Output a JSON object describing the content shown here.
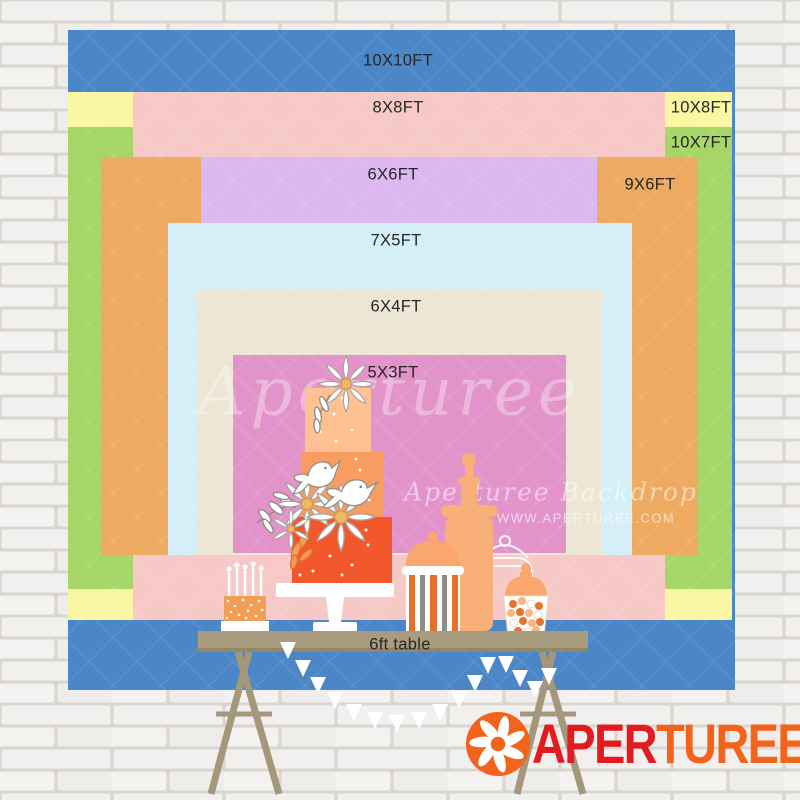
{
  "sizes": [
    {
      "label": "10X10FT",
      "color": "#4b86c6"
    },
    {
      "label": "8X8FT",
      "color": "#f6c9c7"
    },
    {
      "label": "10X8FT",
      "color": "#f9f7a1"
    },
    {
      "label": "10X7FT",
      "color": "#a6d667"
    },
    {
      "label": "6X6FT",
      "color": "#ddb7f0"
    },
    {
      "label": "9X6FT",
      "color": "#edaa60"
    },
    {
      "label": "7X5FT",
      "color": "#d5eff8"
    },
    {
      "label": "6X4FT",
      "color": "#ede6d4"
    },
    {
      "label": "5X3FT",
      "color": "#e294ca"
    }
  ],
  "table": {
    "label": "6ft table",
    "color": "#a99b7d"
  },
  "watermark": {
    "script": "Aperturee",
    "brand": "Aperturee Backdrop",
    "url": "WWW.APERTUREE.COM"
  },
  "logo": {
    "red_text": "APER",
    "orange_text": "TUREE",
    "red": "#e11b20",
    "orange": "#f2641c"
  },
  "wall_color": "#f2f0ee"
}
